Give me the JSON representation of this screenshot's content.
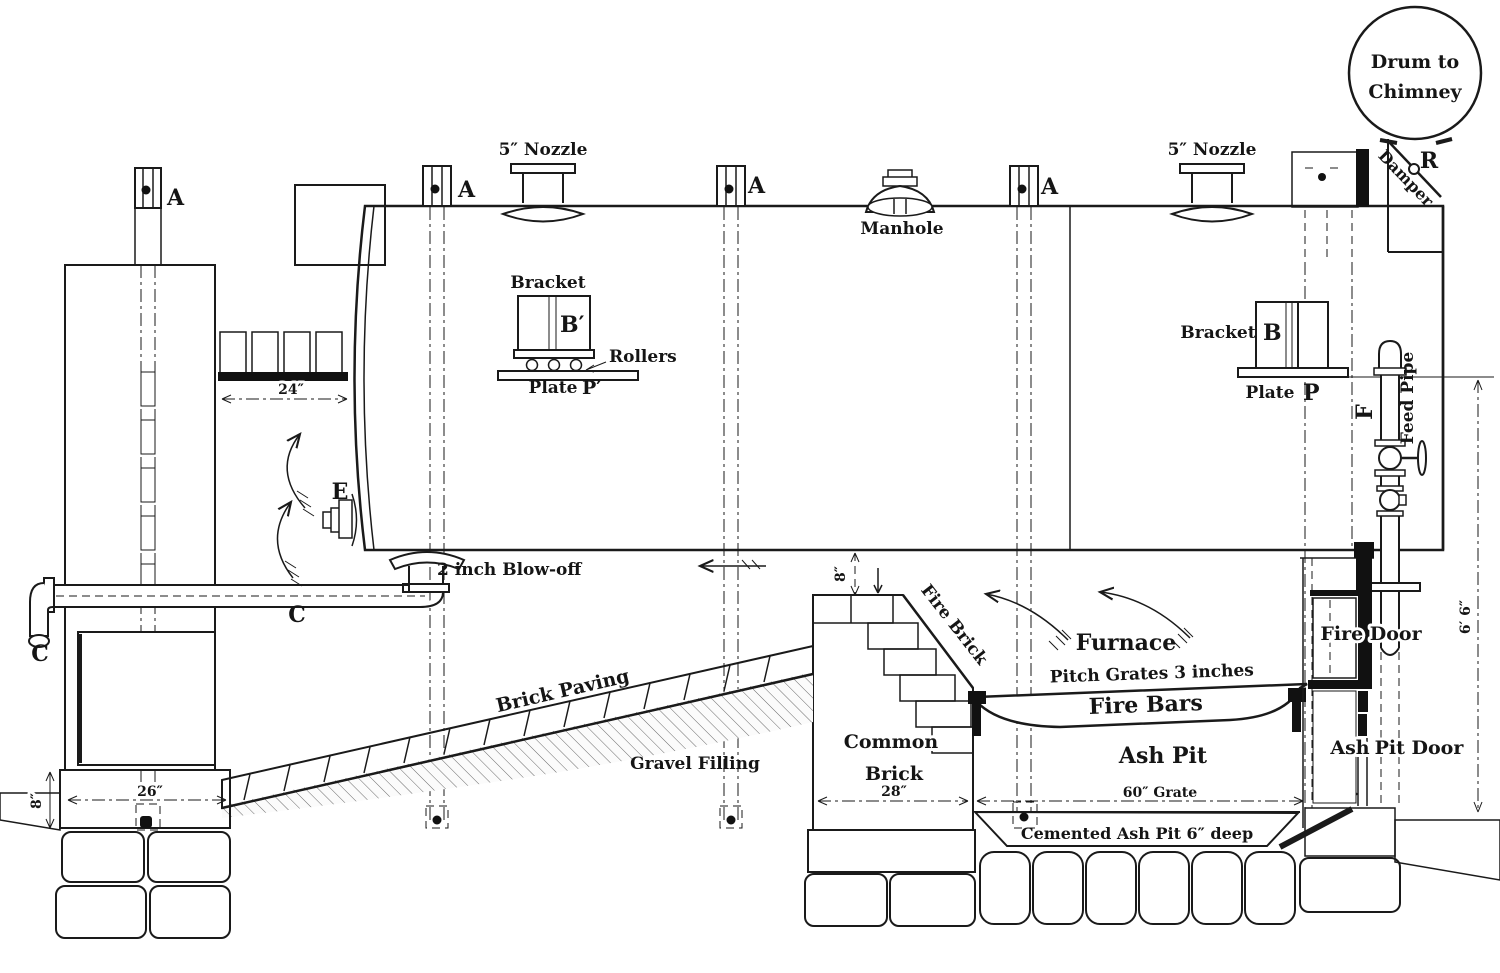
{
  "diagram": {
    "title": "Boiler setting sectional elevation",
    "parts": {
      "drum_line1": "Drum to",
      "drum_line2": "Chimney",
      "damper": "Damper",
      "damper_ref": "R",
      "anchor_ref": "A",
      "nozzle": "5″ Nozzle",
      "manhole": "Manhole",
      "bracket": "Bracket",
      "bracket_ref_left": "B′",
      "bracket_ref_right": "B",
      "rollers": "Rollers",
      "plate": "Plate",
      "plate_ref_left": "P′",
      "plate_ref_right": "P",
      "feed_pipe": "Feed Pipe",
      "feed_pipe_ref": "F",
      "e_ref": "E",
      "blow_off": "2 inch Blow-off",
      "c_ref": "C",
      "brick_paving": "Brick Paving",
      "gravel_filling": "Gravel Filling",
      "fire_brick": "Fire Brick",
      "common_brick_line1": "Common",
      "common_brick_line2": "Brick",
      "furnace": "Furnace",
      "pitch_grates": "Pitch Grates 3 inches",
      "fire_bars": "Fire Bars",
      "ash_pit": "Ash Pit",
      "fire_door": "Fire Door",
      "ash_door_word1": "Ash",
      "ash_door_word2": "Pit Door",
      "cemented_ash_pit": "Cemented Ash Pit 6″ deep"
    },
    "dims": {
      "height": "6′ 6″",
      "gap8": "8″",
      "found8": "8″",
      "found26": "26″",
      "rear24": "24″",
      "pier28": "28″",
      "grate60": "60″ Grate",
      "front5": "5″"
    },
    "colors": {
      "ink": "#1a1a1a",
      "paper": "#ffffff",
      "hatch": "#e4e4e4"
    }
  }
}
